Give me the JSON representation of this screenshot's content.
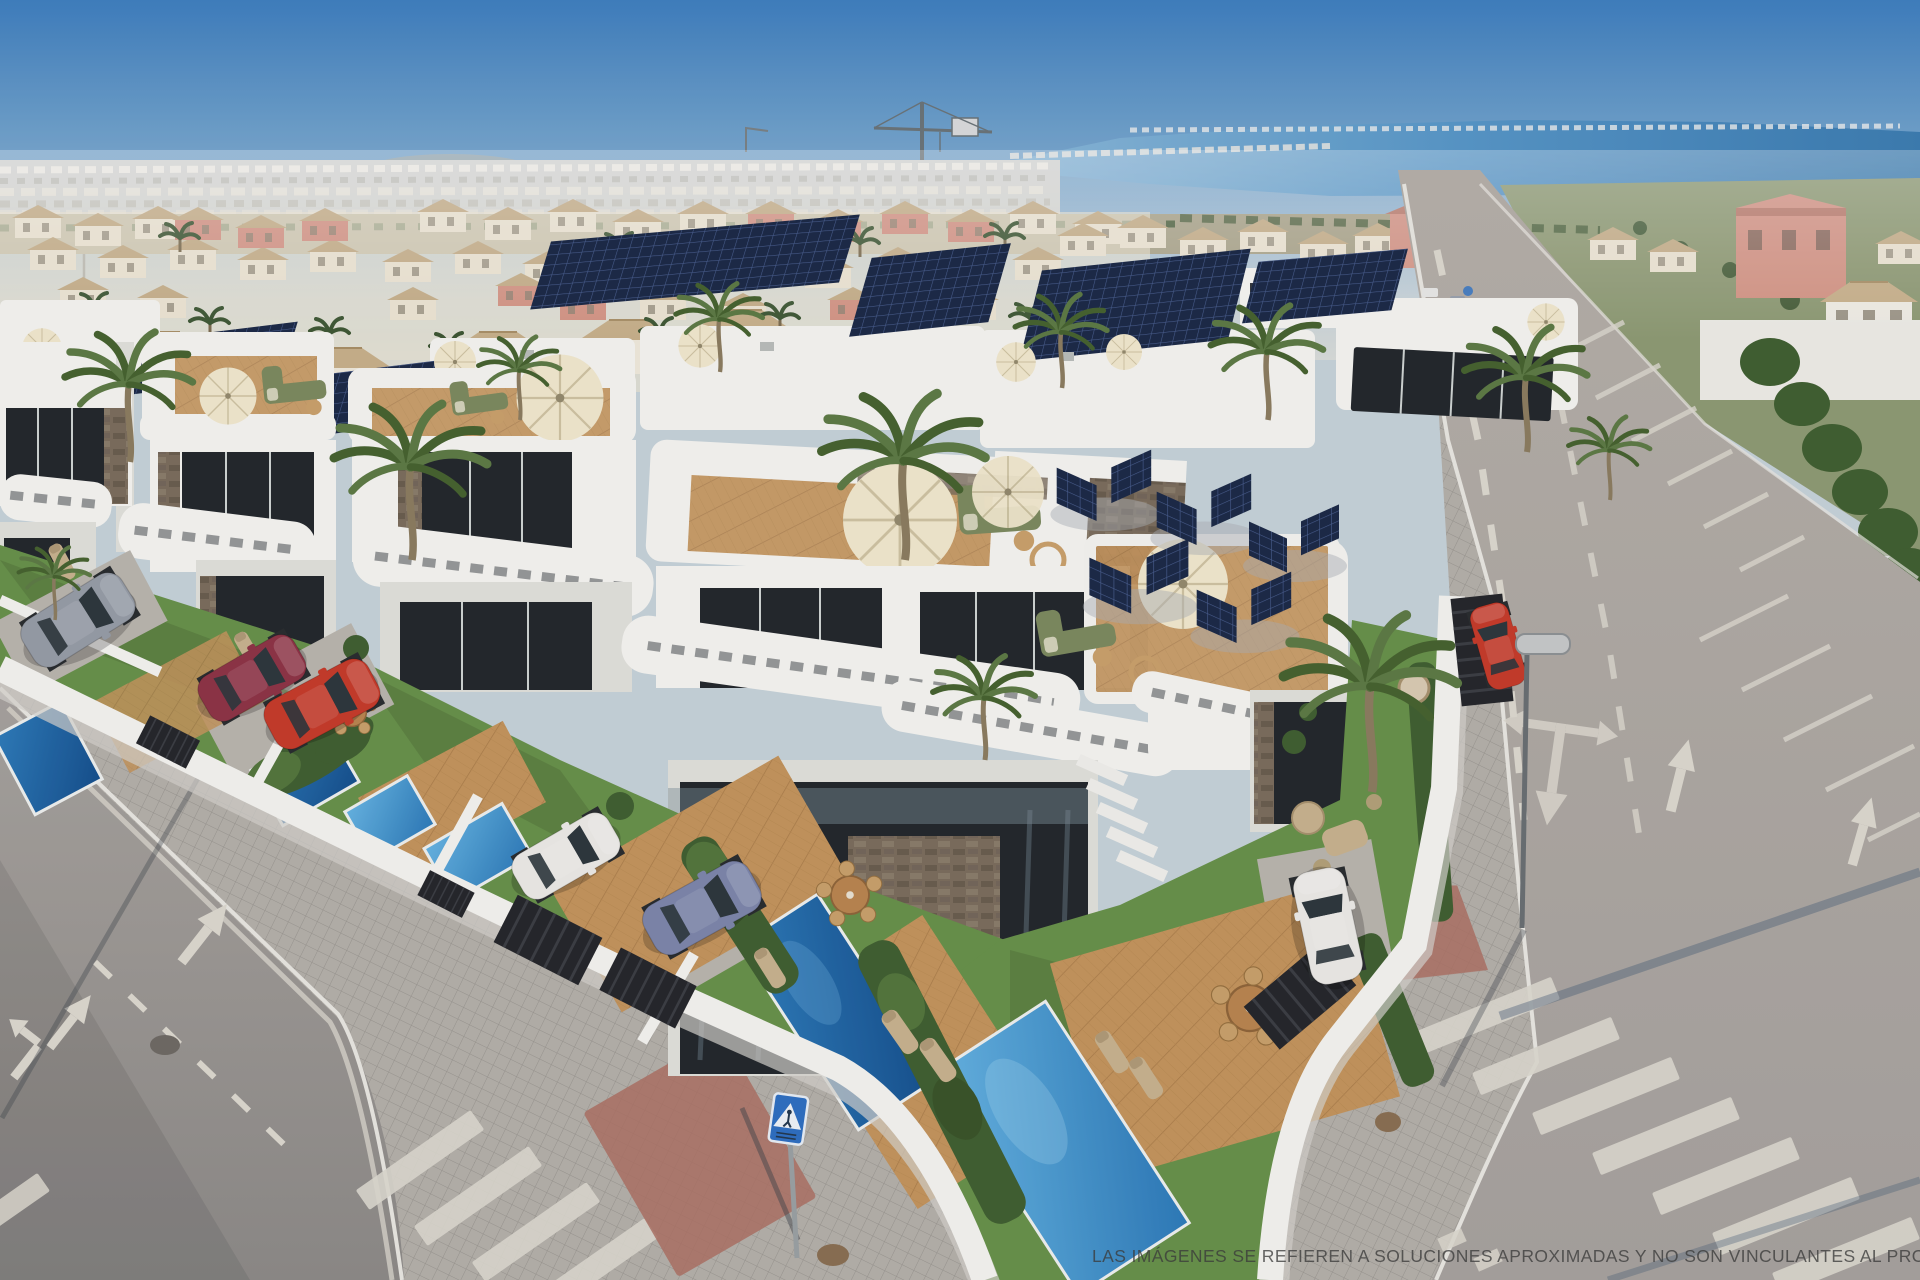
{
  "scene": {
    "setting": "Aerial 3D render of a modern white villa development with rooftop terraces, solar panels, private pools and surrounding streets",
    "sky": {
      "top": "#3f7fbe",
      "horizon": "#c6d2d8"
    },
    "water": {
      "label": "lagoon on horizon",
      "color": "#5796c7"
    },
    "objects": {
      "villas_visible": 10,
      "private_pools": 6,
      "palm_trees": 12,
      "solar_panel_arrays": 7,
      "cars": [
        {
          "id": "gray-suv",
          "color": "#969ca6"
        },
        {
          "id": "maroon-coupe",
          "color": "#8e3446"
        },
        {
          "id": "red-suv",
          "color": "#c63b2a"
        },
        {
          "id": "white-hatchback",
          "color": "#eceae6"
        },
        {
          "id": "violet-coupe",
          "color": "#7d86aa"
        },
        {
          "id": "white-car-right-garden",
          "color": "#eceae6"
        },
        {
          "id": "red-car-right-fence",
          "color": "#c63b2a"
        }
      ],
      "signs": [
        "pedestrian-crossing-sign"
      ],
      "street_furniture": [
        "street-lamp",
        "manhole-covers",
        "construction-crane"
      ],
      "road_markings": [
        "dashed-lane-lines",
        "three-way-arrow",
        "straight-arrows",
        "zebra-crosswalks",
        "diagonal-parking-bays"
      ]
    }
  },
  "disclaimer": {
    "text": "LAS IMÁGENES SE REFIEREN A SOLUCIONES APROXIMADAS Y NO SON VINCULANTES AL PROYECTO FI"
  },
  "palette": {
    "sky-top": "#3f7fbe",
    "sky-mid": "#79a7cd",
    "sky-low": "#c6d2d8",
    "haze": "#d8dbd8",
    "water": "#5796c7",
    "water-deep": "#3c7cb0",
    "hill": "#9ca8ab",
    "field": "#a9a388",
    "field-olive": "#8e9a73",
    "tree": "#3c5531",
    "town-wall": "#ece4d1",
    "town-roof": "#c5ad87",
    "salmon": "#d49484",
    "villa": "#f5f4f0",
    "villa-shade": "#e1e0da",
    "window": "#24282c",
    "stone": "#7b6d5c",
    "solar": "#1c2a47",
    "solar-line": "#4a5e8e",
    "palm": "#5d7a45",
    "palm-dark": "#47632f",
    "grass": "#68914a",
    "hedge": "#415f31",
    "deck": "#c4945c",
    "pool-light": "#58a8da",
    "pool-deep": "#2268aa",
    "road": "#a7a29d",
    "road-far": "#b5afa8",
    "sidewalk": "#b4b0a9",
    "red-pave": "#ad7164",
    "marking": "#dcd8ce",
    "wall-white": "#f4f3ef",
    "umbrella": "#f1e8cd",
    "sofa": "#7c8a5e",
    "furn-tan": "#c8b28e",
    "sign-blue": "#2f6fc0",
    "car-gray": "#969ca6",
    "car-maroon": "#8e3446",
    "car-red": "#c63b2a",
    "car-white": "#eceae6",
    "car-violet": "#7d86aa",
    "gate": "#26272b",
    "curb": "#e9e7e1",
    "text": "#3b3b3b"
  }
}
